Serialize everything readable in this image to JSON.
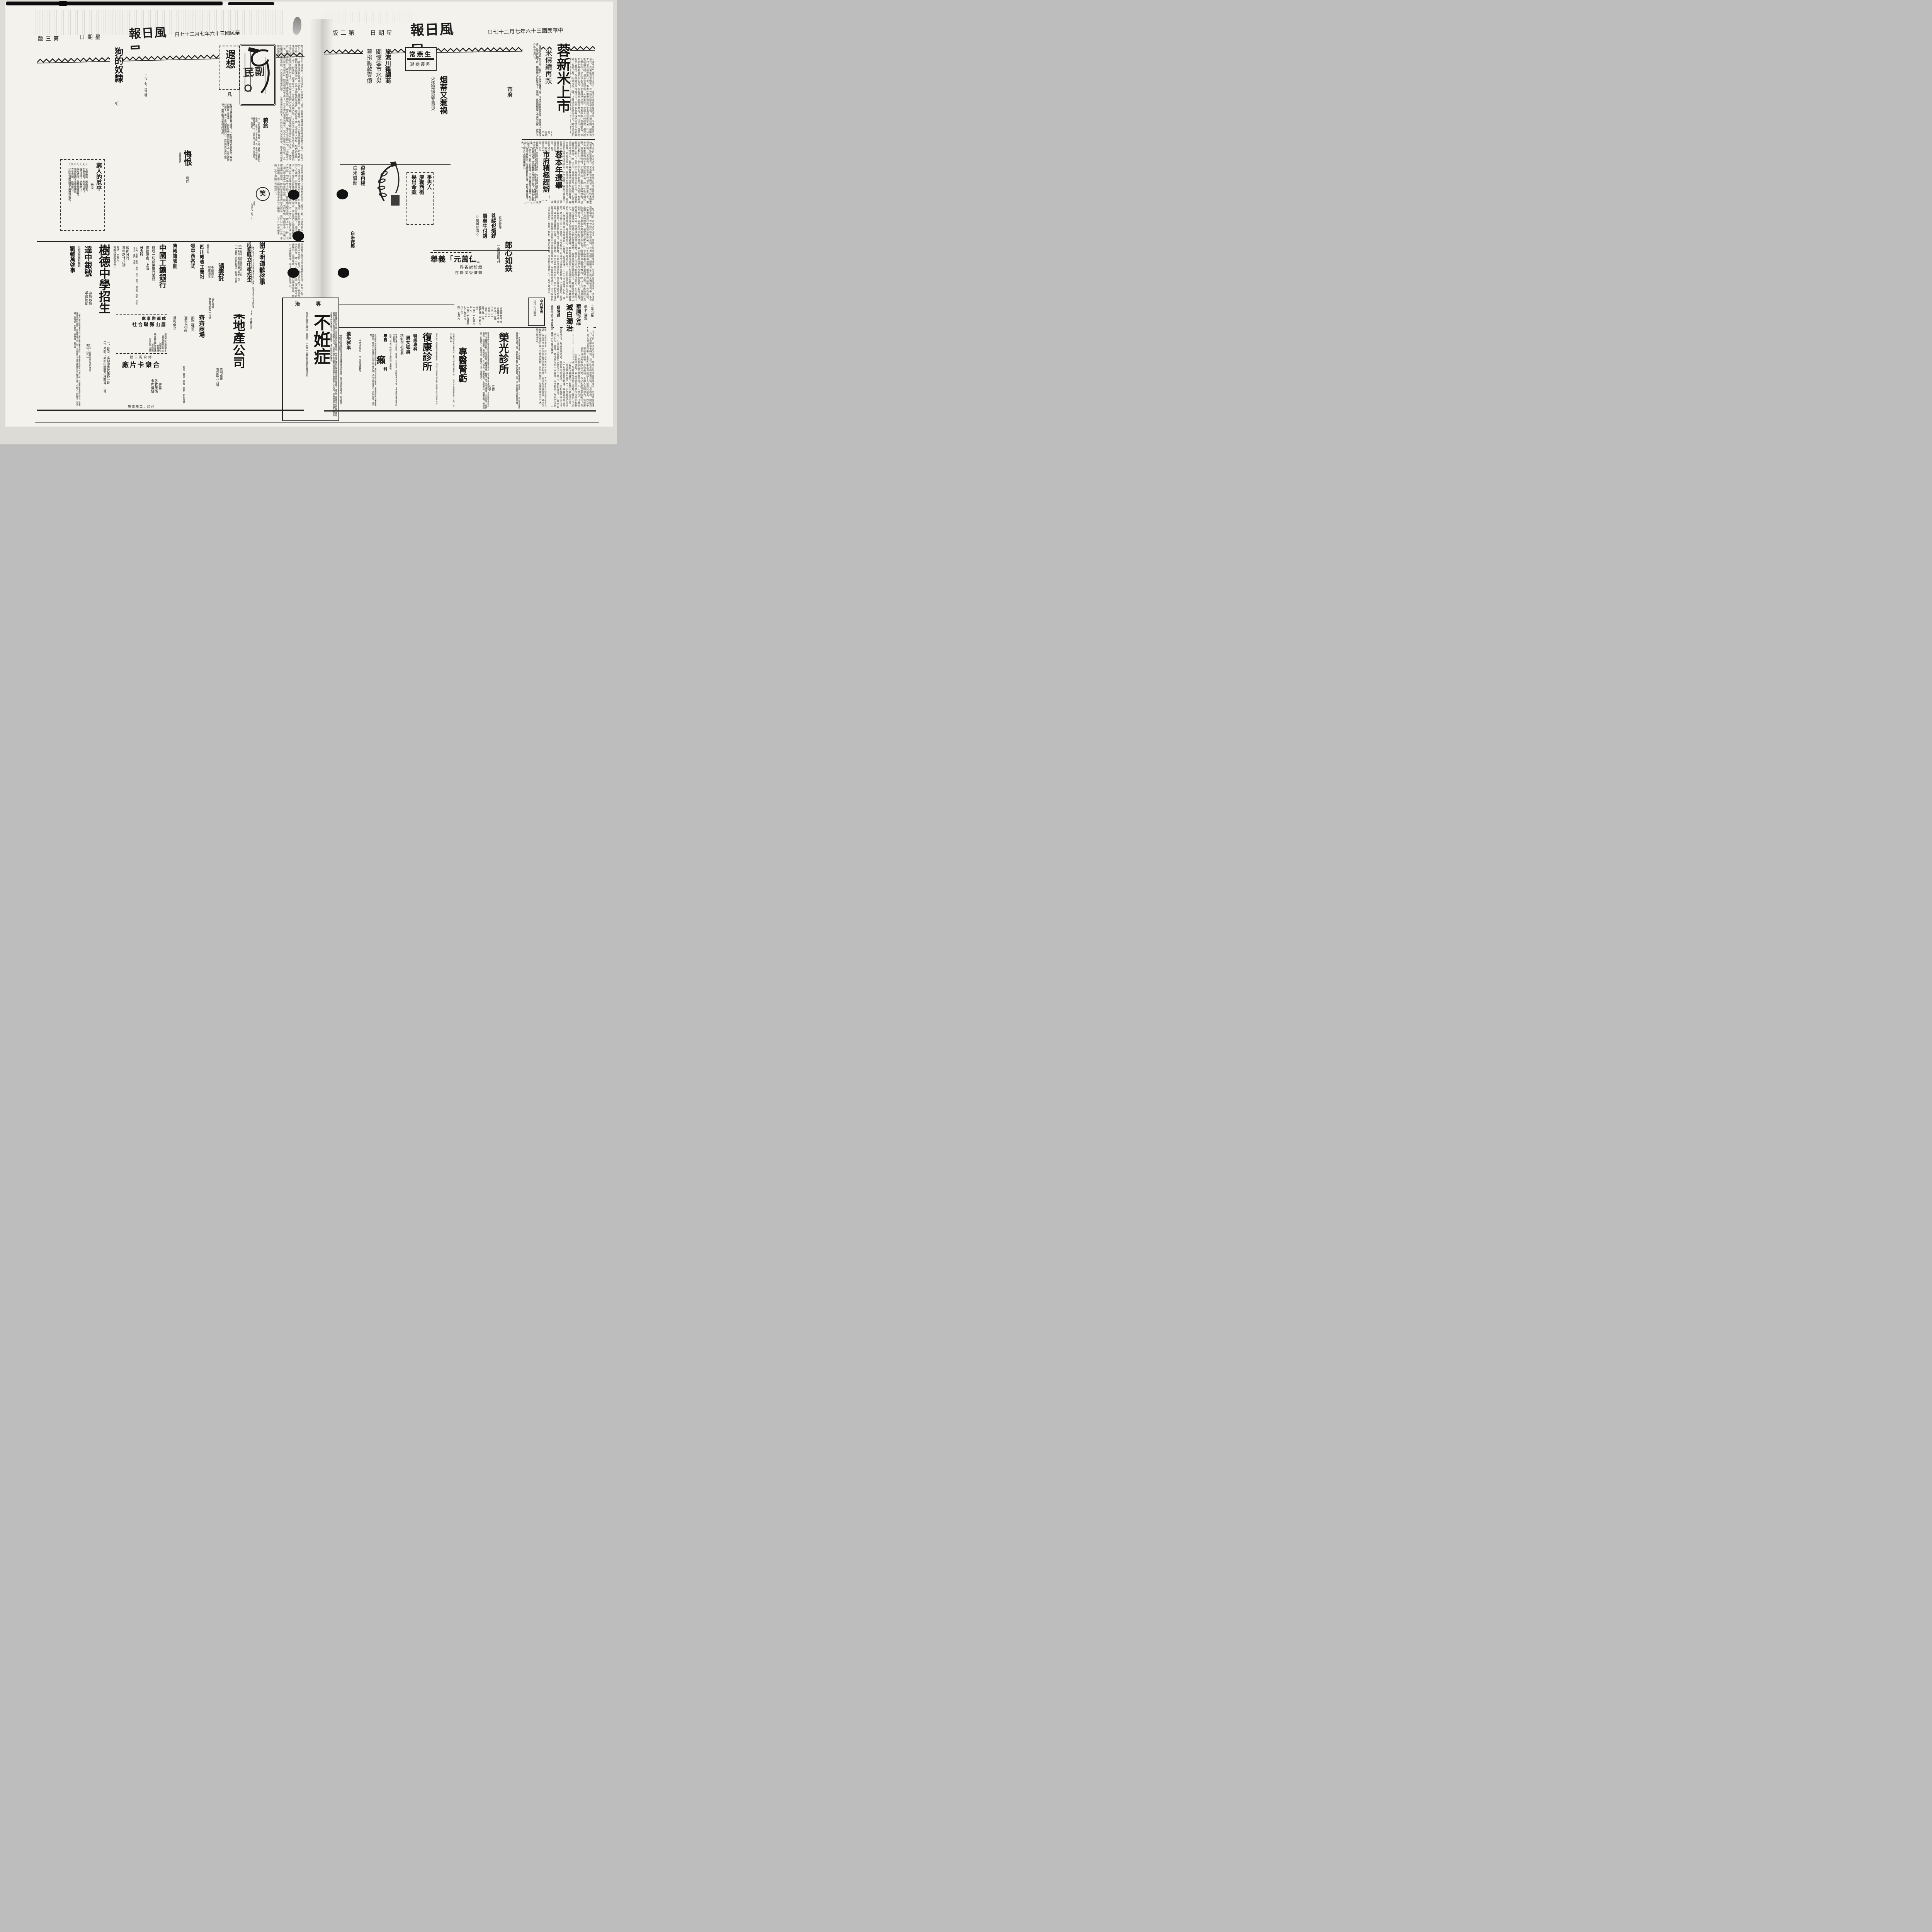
{
  "masthead": {
    "title_rtl": "報日風民",
    "date_rtl": "日七十二月七年六十三國民華中",
    "date_rtl_left": "日七十二月七年六十三國民華",
    "weekday_rtl": "日期星",
    "page2_rtl": "版二第",
    "page3_rtl": "版三第"
  },
  "right": {
    "lead_title": "蓉新米上市",
    "lead_sub": "米價續再跌",
    "lead_body": "【建國社訊】蓉市昨（廿六）日米價繼續下挫，北市已有新米登場，致各商人競相拋售，惟恐再續下跌，據聞每石已跌至七十二萬元，尾盤則隨至七十萬元光景，救濟工作所有進行云。",
    "kicker_city": "市府",
    "election_t1": "蓉本年選舉",
    "election_t2": "市府積極趕辦",
    "election_body": "都市政府本年度選舉，原擬定七月外個區保長及區民代表，與區長至八月始辦之際，本市因生米完水災，即忙於賑濟，已令各區暫行擱置，刻災況大體解決，聞各察員即出發，分赴各區督導，宣以求如期完成云。",
    "yu_name": "余成源",
    "yu_side": "長省會專",
    "lang_t": "郎心如鉄",
    "lang_sub": "一棄婦投井",
    "chang_name": "常燕生",
    "chang_sub_rtl": "逝病晨昨",
    "silk_t1": "旅滬川籍綢商",
    "silk_t2": "關懷蓉市水災",
    "silk_t3": "募捐賑款壹億",
    "cig_t": "烟蒂又惹禍",
    "cig_sub": "火炮聲振屋瓦巨災",
    "murder_t1": "爭男人",
    "murder_t2": "廖雲西街",
    "murder_t3": "幾出命案",
    "oil_t": "菜油再楊",
    "rice_t": "白米微鬆",
    "rice2_t": "白米微鬆",
    "charity_l1": "舉義「元萬伍」",
    "charity_l2": "界各說紛紛",
    "charity_l3": "民居災受濟賑",
    "buddha_t1": "菩薩也愛鈔",
    "buddha_t2": "買藥牛付錢",
    "buddha_t3": "◇錦城拾零◇",
    "prices": "△五萬九千元\n△五萬七千元\n△九十二元\n×八十元\n△三十元\n△四十元\n肚子絲（兩）\n遲把絲（二百市兩）\n一百一十七萬八千元\n一百一十九萬元\n七千九百元\n八千元\n四十五萬元",
    "rong_t": "榮光診所",
    "rong_side": "五特\n大點",
    "rong_list": "一、白濁新藥治療三日痊癒，二、魚口下疳靈桃立刻止痛，三、腎虧夢遺梅毒負責治癒，四、精制包皮繭子男女狐臭，五、以上各病限期負責除根。",
    "rong_addr": "地址：凍青樹街三十號獨院妙高樓對門",
    "kid_t": "專醫腎虧",
    "kid_body": "啓者腎虧之病皆由犯手淫過多或誤不早治，若不乘治百病叢生，不但無有快樂之日，而且壽亦促矣。主治列後：臨陣退縮，精關不固，手淫過度，心志不寧，夜夢遺精，房勞過度，陽物短小，五心煩熱，腰痠腿軟，小便不禁，頭暈耳鳴，相火易動，四肢無力，記憶不良，虛陽不上升，皆能善治。",
    "kid_price": "元轉強砂丸每瓶九千元每打六瓶外購樂加一　九包全愈此每包一千元　古方白帶丹",
    "fu_t": "復康診所",
    "fu_side": "本所為了便利貧病起見各科一律特別減收掛號金半價優待辦法詳詢本所",
    "fox_t1": "特設專科",
    "fox_t2": "男女狐臭",
    "fox_t3": "精制包皮過長",
    "fox_body": "痔瘡肛瘺刀圭結紮，無痛苦一次全愈一次除根永不再發，血管瘤粉瘤各種外科手術精良。",
    "fox_time": "時間：午前八時起至午後四鐘止屋照常",
    "fox_addr": "地址：五時前止與閣隔壁復康所申退費尚店登使",
    "lai_t1": "專醫",
    "lai_big": "癩",
    "lai_t2": "科",
    "lai_body": "新發明神效藥能治萬年久病不愈者，專診治如數次即愈，身體健康大有害即本陸特效，若有小兒頭部白禿即白毛癩之煩，切勿忽視宜速治，否則即成千古之恨。",
    "lai_addr": "中西順城街一二七號伯康醫院",
    "lost_t": "遺失啓事",
    "lost_body": "敝號所有晉豐號簽發渝市匯票壹紙業已遺失，除申請另行補發外，特此聲明作廢。張江氏啓。",
    "inf_hdr_rtl": "治　專",
    "inf_t": "不姙症",
    "inf_body": "育敏醫師已得小孩九個並在蓉治愈無算症，所現存之像片及酬謝物品等即為證見。衆治男女曆醫未愈醉礙生育有礙難性病及花柳隱症均有種子秘法，注手即治不孕者劑送精製包皮在蓉割有十餘大瓶，成績特點不流血不痛苦不危險不畸形不礙工作，限期痊愈，送打防疫針送藥水。",
    "inf_foot": "每日七鐘至五鐘止　西御街一一七號中央電影院隔壁彭鉄珊診所",
    "med_l1": "上海出品",
    "med_l2": "新老白濁",
    "med_l3": "華勝之品",
    "med_l4": "滅白濁治",
    "med_l5": "經售處",
    "med_l6": "總府街太平洋大藥房　鹽市口生生大藥房",
    "jin_t": "今作學會",
    "jin_sub": "八月一日成立"
  },
  "left": {
    "xia_t": "遐想",
    "xia_author": "凡",
    "xia_body": "斜陽塗抹着黃昏的殘塔，人影兒與塔影兒相伴。無雲的獨自立在江干，塔影兒不閃悄然在江上，當這黃昏兒將下！第一是光明來自何方，默默的向長空兒瞻望，劃不斷勾愁舊恨的情緣。",
    "xia_sig": "三六，七，望江樓",
    "logo_label": "民副",
    "gao_t": "稿約",
    "gao_body": "一、凡反映現實之雜感、小品、詩歌、漫畫均所歡迎。文字以八百字為限。二、來稿一經登載，略致薄酬。三、來稿恕不退還，請自留底稿。四、寫清楚。",
    "dog_t": "狗的奴隸",
    "dog_author": "虹",
    "hui_t": "悔恨",
    "hui_note": "（中篇連載）",
    "hui_author": "劍煃",
    "laugh_t": "笑",
    "laugh_sig": "小琪\n一九四七，五，十",
    "poor_t": "窮人的厄平",
    "poor_author": "禾戈",
    "poor_items": "1、米價高漲，米蟲鬧重。\n2、大雨連天，水災益患！\n3、瘟疫流行，施醫者少。\n4、柴炭價漲，樂禁餓寒若是。\n5、施米廠因米完而告閉歇。\n6、大小當鋪，此時慢收！\n7、法院監獄因囚糧不繼而釋罪犯！",
    "ads": {
      "dz_t": "達中銀號",
      "dz_b": "存款放款\n手續簡便",
      "dz_addr": "行址：總府街拾號附壹號\n電話：四六一",
      "liu_intro": "介紹漏症特科醫師",
      "liu_t": "劉輔萬啓事",
      "liu_body": "一種凡患牙腰腎漏五症，漏症無不藥到病除，其治漏症為敝人特為介紹，凡患斯疾者渴往試之，劉君現開設特科診所，早根除患不用刀剖，常有醫生不及之病除其乃治難而治癒。介紹人：張聯芳　況鴻翔　曾南夫　李煜如　孫懋頤　袁子澤",
      "shude_t": "樹德中學招生",
      "shude_b": "一、班次：高初中男女生各一班\n二、考期：高初中國曆八月四日、六日",
      "bank_t": "中國工鑛銀行",
      "bank_b1": "辦理一切商業銀行業務",
      "bank_b2": "總管理處：上海",
      "bank_b3": "分支行",
      "bank_cities": "上海　重慶　南京　廣州　長沙　漢口　自貢市　西安　昆明　青島　廈門　寶雞",
      "bank_cd": "成都分行\n青年路廿八號",
      "bank_tel": "電話　三九六\n電報掛號四零三三",
      "ms_l1": "處事辦都成",
      "ms_l2": "社合聯縣山眉",
      "ms_body": "運到大批松柴開水\n暑期間售完為止\n減價犧牲\n壹萬梱\n機會難得購者從速\n以免向隅\n水津街十八號",
      "card_l1": "號三街府總",
      "card_l2": "廠片卡衆合",
      "card_b": "專售\n各式美術\n卡片請帖",
      "card_foot": "廉價精工：印代",
      "zb_c1": "發中西各式",
      "zb_c2": "售帳簿表冊",
      "wa": "襪衫俱全",
      "sc_small": "春熙西段",
      "sc_t": "四川帳表工業社",
      "qq_c1": "商業場口",
      "qq_t": "齊齊商場",
      "qq_c2": "航空運到",
      "qq_c3": "夏季用品",
      "qq_cities": "雅安　西昌　榮經　昆明　新街九號",
      "jy_hdr": "買賣田房地產",
      "jy_qing": "請委託",
      "jy_t": "基業地產公司",
      "jy_s1": "手續週到\n辦事徹底",
      "jy_s2": "公司地址\n海會寺街四一八號",
      "jy_s3": "不明手續　取費低廉",
      "jy_s4": "信用卓著\n電話四八八號",
      "xie_t": "謝子明道歉啓事",
      "xie_body": "敝人於七月廿五日在提督東街三乾行館內，因事冒犯六十七師駐軍某先生，事後深覺失禮，特此登報道歉。",
      "cd_t": "成都縣立中學招生",
      "cd_b": "【一】班次：高初中新生各一班\n【二】考試：高初中國曆八月十一日\n【三】日期：即日起報名　校址：外西"
    }
  },
  "filler": {
    "long1": "在人間罵人的口頭禪有：「你這個狗×的東西」之語，其意大概是說被罵者連狗都不如了。狗在人們的心目中，彷彿生來就是卑賤的畜生，搖頭擺尾，仰人鼻息，靠主人的殘羹剩飯過活。可是現在卻有些人，競相豢養起洋狗來，這些洋狗住的是洋房，吃的是牛肉，還有專人伺候，牠們的身價，遠在窮人之上了。假使說，都洋氣十分，神氣時人也被活現，大有要不完這個世界之勢。這些洋狗之所以胖，是因為牠們的主人，時時解決了牠們的肉之類。「你家裏難道沒有另外的人嗎」？她看我一眼沒有說話。「難道你家裏除了你後母和你爸爸，就只有你嗎」？我又這末問一句。「我後母去八市，這兒只有爸爸和我」。她再把頭低下去了。江水流向遠遠地彼方，流不去那古今的惆悵，且把幽懷的惜恨長噓，向着清風遐想遐想……當這黃昏兒將下，默默的向長空兒瞻望，劃不斷勾愁舊恨的情緣。",
    "long2": "可是她的後母又不能再想到什麼，祖母一起，不過時我沒有感到，當時因為Ａ城沒有高中，所以我寫一封信給爸爸，告訴他想到Ｃ市讀書，但他沒有回信，很久，我母親生病了，他去外面流浪，後三個月他就離家，一直沒回去，所以我們之間是隔膜的。省垣公私立各中學聯合招考委員會，昨（廿六）日舉行第二次聯合考試，到考學生千餘人，情形頗為緊張云。昨上午十一時，北三街口有卡車一輛疾馳而過，將一老婦擊倒，當即斃命，司機已被扣押訊辦云。特約記者謂省府俯念孤苦，已於日前（廿五）悉予以補助，據云議決通過七千萬元之補助，八五○次省務會議，准予補助以資救濟云。",
    "long3": "【本報訊】此次水災基巨，旅滬川籍綢商關懷桑梓，特電匯賑款壹億元，交省賑濟會轉發，並分飭各縣查報災情，以憑核辦，聞賑濟工作刻正積極進行中。本市外東宏濟路四十五號居民彭某，昨日午後吸烟就寢，烟蒂引燃蚊帳，火勢蔓延，幸鄰人及時撲救，僅焚屋瓦數十匹，查此係本月以來第四次火警，市民殊應注意防範云。青年黨中央委員常燕生氏，因腦溢血症醫治無效，昨（廿六）日晨病逝市立醫院，各界聞訊深致悼惜云。省立省會專科學校校長未愈辭職，省府已准，所遺校長一職，已聘請余成源氏接充，聞余氏已於日前到校視事云。本市前四川省銀行職員某，因愛人變心憤而投井，幸被發現救起尚能囘生，聞該棄婦年僅二十，伊感世道之炎涼遂萌短見云。本市廖雲西街四十九號居民彭邦傑，與其妻日前口角相打成傷，轄區警局聞訊，將兇手拘案訊辦，一俟相驗明確即依法訊辦云。△菜油每市秤百斤昨價五十二萬元，較前微漲。△本市白米每市石七十萬元，老斗百斤四十五萬元，南市較疲。昨日市場白米交易甚微，仍呈疲軟，因連日新穀登場，行情自趨下游，惟銀根緊，四鄉米源源湧到，米多價跌當可想見云。某寺僧徒買藥牛付錢，菩薩也愛鈔。本市各中學招考新生，學生們於深夜認眞溫習功課，某校學生竟有因考試緊張而失眠者，家長殊為憂慮云。本市某棺材店正設計製一部特大棺材，其外加棺套，聞係預定者出力大，現欠定金云。"
  }
}
